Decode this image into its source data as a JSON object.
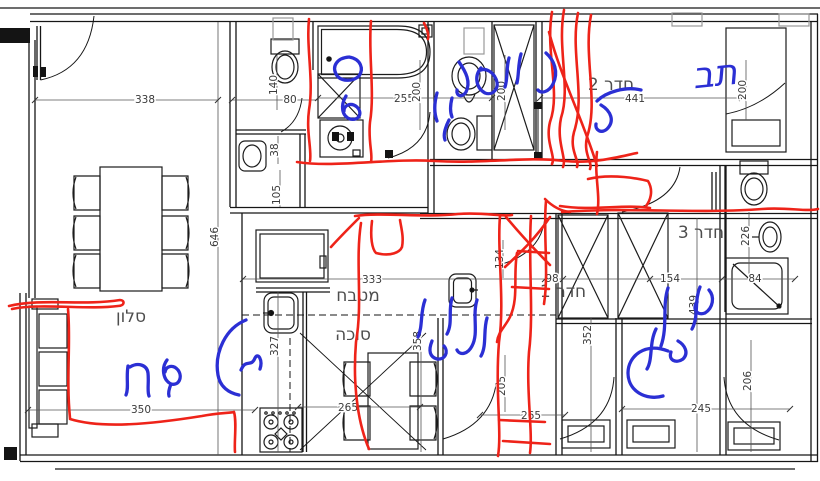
{
  "title": "apartment floor plan with red and blue hand annotations",
  "colors": {
    "wall": "#161616",
    "dim_line": "#555555",
    "dim_text": "#3a3a3a",
    "label_text": "#4d4d4d",
    "shaft_gray": "#999999",
    "ink_red": "#ee2319",
    "ink_blue": "#2b2fd4"
  },
  "room_labels": [
    {
      "text": "חדר 2",
      "x": 611,
      "y": 90
    },
    {
      "text": "חדר 3",
      "x": 701,
      "y": 238
    },
    {
      "text": "חדר 1",
      "x": 563,
      "y": 297
    },
    {
      "text": "מטבח",
      "x": 358,
      "y": 301
    },
    {
      "text": "סוכה",
      "x": 353,
      "y": 340
    },
    {
      "text": "סלון",
      "x": 131,
      "y": 322
    }
  ],
  "dimensions": [
    {
      "value": "338",
      "x": 145,
      "y": 103,
      "rot": false
    },
    {
      "value": "140",
      "x": 277,
      "y": 85,
      "rot": true
    },
    {
      "value": "80",
      "x": 290,
      "y": 103,
      "rot": false
    },
    {
      "value": "255",
      "x": 404,
      "y": 102,
      "rot": false
    },
    {
      "value": "200",
      "x": 420,
      "y": 92,
      "rot": true
    },
    {
      "value": "200",
      "x": 505,
      "y": 91,
      "rot": true
    },
    {
      "value": "441",
      "x": 635,
      "y": 102,
      "rot": false
    },
    {
      "value": "200",
      "x": 746,
      "y": 90,
      "rot": true
    },
    {
      "value": "38",
      "x": 278,
      "y": 150,
      "rot": true
    },
    {
      "value": "105",
      "x": 280,
      "y": 195,
      "rot": true
    },
    {
      "value": "646",
      "x": 218,
      "y": 237,
      "rot": true
    },
    {
      "value": "333",
      "x": 372,
      "y": 283,
      "rot": false
    },
    {
      "value": "98",
      "x": 552,
      "y": 282,
      "rot": false
    },
    {
      "value": "154",
      "x": 670,
      "y": 282,
      "rot": false
    },
    {
      "value": "84",
      "x": 755,
      "y": 282,
      "rot": false
    },
    {
      "value": "226",
      "x": 749,
      "y": 236,
      "rot": true
    },
    {
      "value": "134",
      "x": 503,
      "y": 259,
      "rot": true
    },
    {
      "value": "327",
      "x": 278,
      "y": 346,
      "rot": true
    },
    {
      "value": "358",
      "x": 421,
      "y": 341,
      "rot": true
    },
    {
      "value": "352",
      "x": 591,
      "y": 335,
      "rot": true
    },
    {
      "value": "439",
      "x": 697,
      "y": 305,
      "rot": true
    },
    {
      "value": "205",
      "x": 505,
      "y": 386,
      "rot": true
    },
    {
      "value": "265",
      "x": 348,
      "y": 411,
      "rot": false
    },
    {
      "value": "265",
      "x": 531,
      "y": 419,
      "rot": false
    },
    {
      "value": "350",
      "x": 141,
      "y": 413,
      "rot": false
    },
    {
      "value": "245",
      "x": 701,
      "y": 412,
      "rot": false
    },
    {
      "value": "206",
      "x": 751,
      "y": 381,
      "rot": true
    }
  ],
  "handwriting": [
    {
      "text": "תב",
      "x": 716,
      "y": 86,
      "size": 36,
      "rotate": -6,
      "color": "blue"
    }
  ],
  "ink": {
    "red": [
      "M309,19 C306,48 314,80 309,110 C306,132 312,150 310,161",
      "M371,21 C368,52 375,92 370,122 C368,142 373,154 371,162",
      "M297,162 C335,168 390,158 435,161 C485,164 525,156 565,161 C595,164 622,156 637,153",
      "M552,12 C545,52 561,92 550,122 C545,142 556,156 552,164",
      "M564,10 C557,48 571,88 561,118 C556,142 567,158 563,167",
      "M578,13 C570,52 586,96 574,132 C569,150 580,161 577,167",
      "M591,15 C583,56 599,102 587,137 C583,154 593,163 590,169",
      "M549,32 C561,78 584,122 597,166",
      "M597,152 C594,176 601,196 597,214",
      "M588,179 C612,173 640,179 648,181 C654,191 650,201 646,206",
      "M560,206 C592,211 624,204 650,208",
      "M562,212 C625,207 700,214 762,209 C788,207 806,212 818,209",
      "M545,199 C552,206 560,211 570,212",
      "M546,201 C543,232 549,272 544,304",
      "M518,251 L549,253",
      "M512,287 L549,289",
      "M517,253 C513,276 519,298 510,317 C505,327 498,332 497,342",
      "M506,217 C521,235 536,251 550,265",
      "M550,217 C536,238 520,253 505,267",
      "M531,216 C528,262 534,312 529,352 C526,392 533,432 530,453",
      "M500,216 C497,252 505,302 499,342 C495,392 502,432 498,456",
      "M499,420 L545,422",
      "M503,441 L550,444",
      "M355,216 C382,212 422,218 458,214 C484,212 502,217 512,215",
      "M372,221 C370,237 372,249 376,253 C391,257 400,252 402,247 C404,237 401,227 400,220",
      "M359,218 C349,228 339,238 331,247",
      "M361,223 C355,262 363,302 356,342 C352,392 360,428 369,449",
      "M424,23 C427,29 429,34 428,39",
      "M9,306 C42,298 82,306 120,300 C125,300 125,306 118,306 C88,310 40,303 12,309",
      "M68,309 C71,342 66,378 70,418",
      "M70,419 C102,429 152,424 202,416 C217,413 230,413 234,412 C237,422 234,442 235,452"
    ],
    "blue": [
      "M349,57 C337,58 332,66 336,74 C340,82 353,82 359,76 C364,69 361,59 349,57",
      "M346,96 C340,106 342,116 350,119 C359,121 363,113 357,107 C351,102 344,105 344,111",
      "M437,93 C434,104 434,113 437,121",
      "M449,120 C445,128 443,135 445,140",
      "M452,98 C450,106 450,112 452,117",
      "M459,62 C466,72 471,82 466,92 C462,98 456,96 457,90",
      "M481,68 C474,76 476,88 485,93 C493,96 500,88 496,79 C493,72 486,68 481,70",
      "M509,58 C506,68 508,78 505,87",
      "M521,54 C518,64 519,74 517,83",
      "M546,53 C554,60 559,72 553,84 C549,92 541,94 538,90",
      "M641,90 C626,86 606,92 597,101",
      "M601,105 C611,111 615,121 607,129 C601,134 595,130 596,124",
      "M425,300 C420,313 423,326 418,337",
      "M432,341 C428,351 430,357 437,359 C445,360 449,352 444,346",
      "M452,298 C448,311 453,323 447,334",
      "M477,300 C472,316 479,333 472,346 C468,354 460,356 457,350",
      "M487,318 C483,331 487,345 481,356",
      "M700,287 C694,301 699,316 692,329",
      "M709,290 C715,297 713,308 705,313 C697,316 692,309 697,302",
      "M668,288 C662,306 668,326 661,346",
      "M678,341 C685,345 689,353 683,359 C676,364 668,360 671,352",
      "M656,329 C649,343 653,359 647,369",
      "M668,351 C645,342 628,356 628,373 C628,391 646,401 663,396",
      "M128,366 C126,378 129,388 126,395",
      "M130,367 C138,362 147,365 148,373 C149,383 147,391 149,396",
      "M167,360 C161,368 163,380 171,384 C179,386 183,377 178,370 C173,364 166,366 165,372",
      "M171,384 C169,389 168,393 169,396",
      "M246,320 C226,328 214,352 218,375 C220,387 229,393 239,395",
      "M241,370 C246,358 251,368 255,358 C258,352 263,360 260,369"
    ]
  }
}
